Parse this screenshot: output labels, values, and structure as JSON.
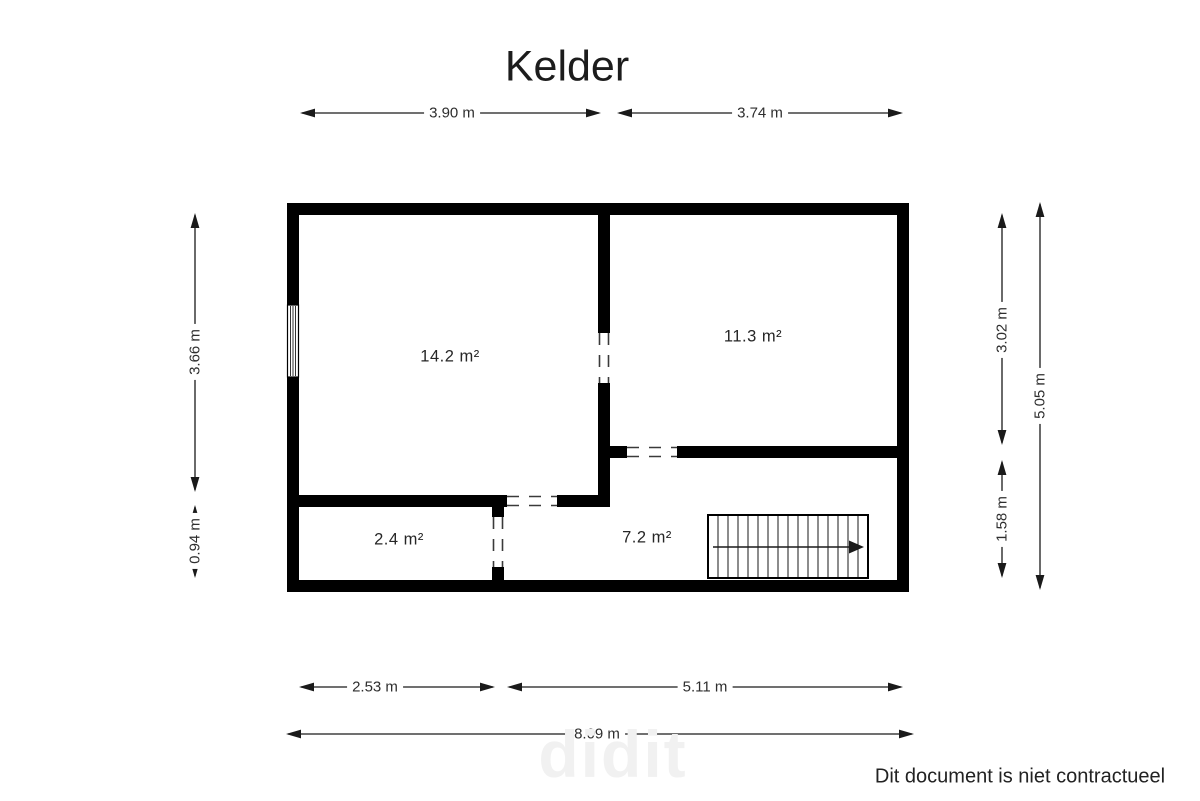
{
  "title": "Kelder",
  "rooms": [
    {
      "area_label": "14.2 m²"
    },
    {
      "area_label": "11.3 m²"
    },
    {
      "area_label": "2.4 m²"
    },
    {
      "area_label": "7.2 m²"
    }
  ],
  "dimensions": {
    "top": [
      {
        "label": "3.90 m"
      },
      {
        "label": "3.74 m"
      }
    ],
    "left": [
      {
        "label": "3.66 m"
      },
      {
        "label": "0.94 m"
      }
    ],
    "right": [
      {
        "label": "3.02 m"
      },
      {
        "label": "1.58 m"
      },
      {
        "label": "5.05 m"
      }
    ],
    "bottom": [
      {
        "label": "2.53 m"
      },
      {
        "label": "5.11 m"
      },
      {
        "label": "8.09 m"
      }
    ]
  },
  "footer": {
    "disclaimer": "Dit document is niet contractueel"
  },
  "watermark_text": "didit",
  "colors": {
    "wall": "#000000",
    "dim_text": "#2e2e2e",
    "door_dash": "#3a3a3a",
    "watermark": "#f1f1f1"
  }
}
